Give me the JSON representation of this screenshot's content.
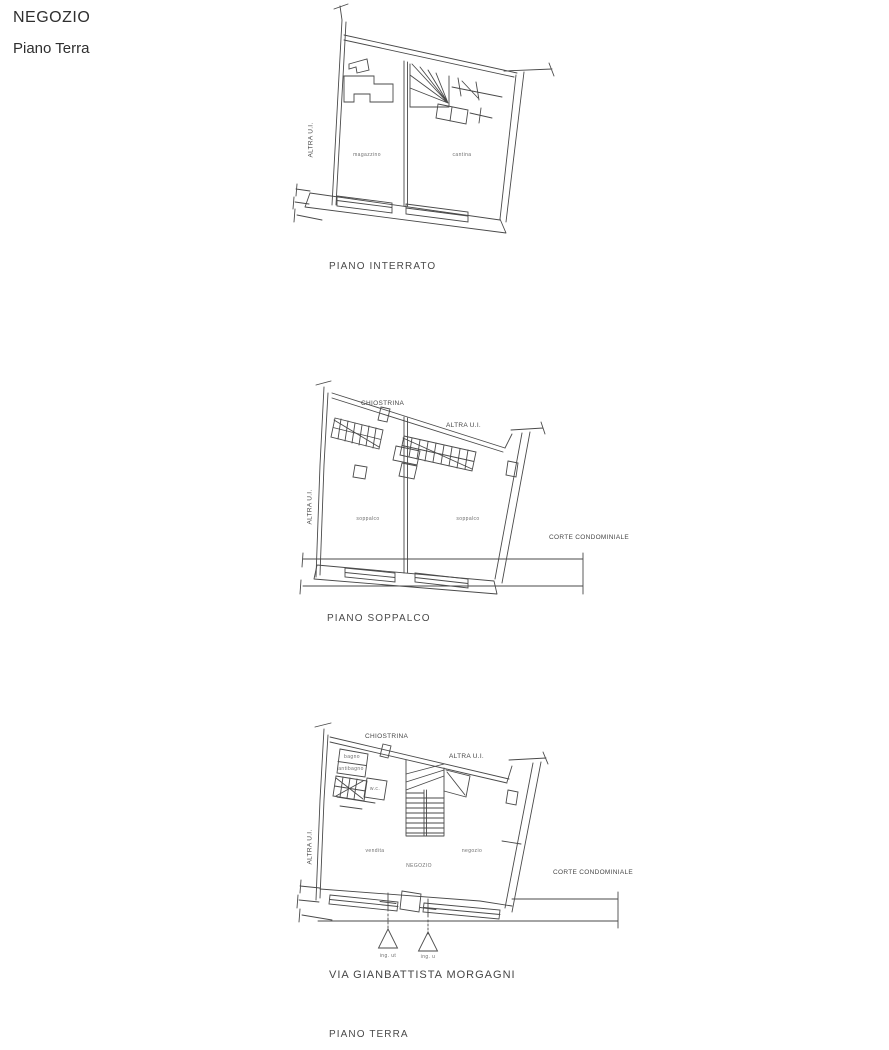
{
  "header": {
    "title": "NEGOZIO",
    "subtitle": "Piano Terra"
  },
  "colors": {
    "line": "#4a4a4a",
    "text": "#3a3a3a"
  },
  "plan_interrato": {
    "caption": "PIANO INTERRATO",
    "altra_ui_left": "ALTRA U.I.",
    "room_left": "magazzino",
    "room_right": "cantina"
  },
  "plan_soppalco": {
    "caption": "PIANO SOPPALCO",
    "chiostrina": "CHIOSTRINA",
    "altra_ui_top": "ALTRA U.I.",
    "altra_ui_left": "ALTRA U.I.",
    "corte": "CORTE CONDOMINIALE",
    "room_left": "soppalco",
    "room_right": "soppalco"
  },
  "plan_terra": {
    "caption": "PIANO TERRA",
    "street": "VIA GIANBATTISTA MORGAGNI",
    "chiostrina": "CHIOSTRINA",
    "altra_ui_top": "ALTRA U.I.",
    "altra_ui_left": "ALTRA U.I.",
    "corte": "CORTE CONDOMINIALE",
    "room_left": "vendita",
    "room_center": "NEGOZIO",
    "room_right": "negozio",
    "bagno": "bagno",
    "antibagno": "antibagno",
    "wc": "w.c.",
    "entrance_left": "ing. ut",
    "entrance_right": "ing. u"
  }
}
